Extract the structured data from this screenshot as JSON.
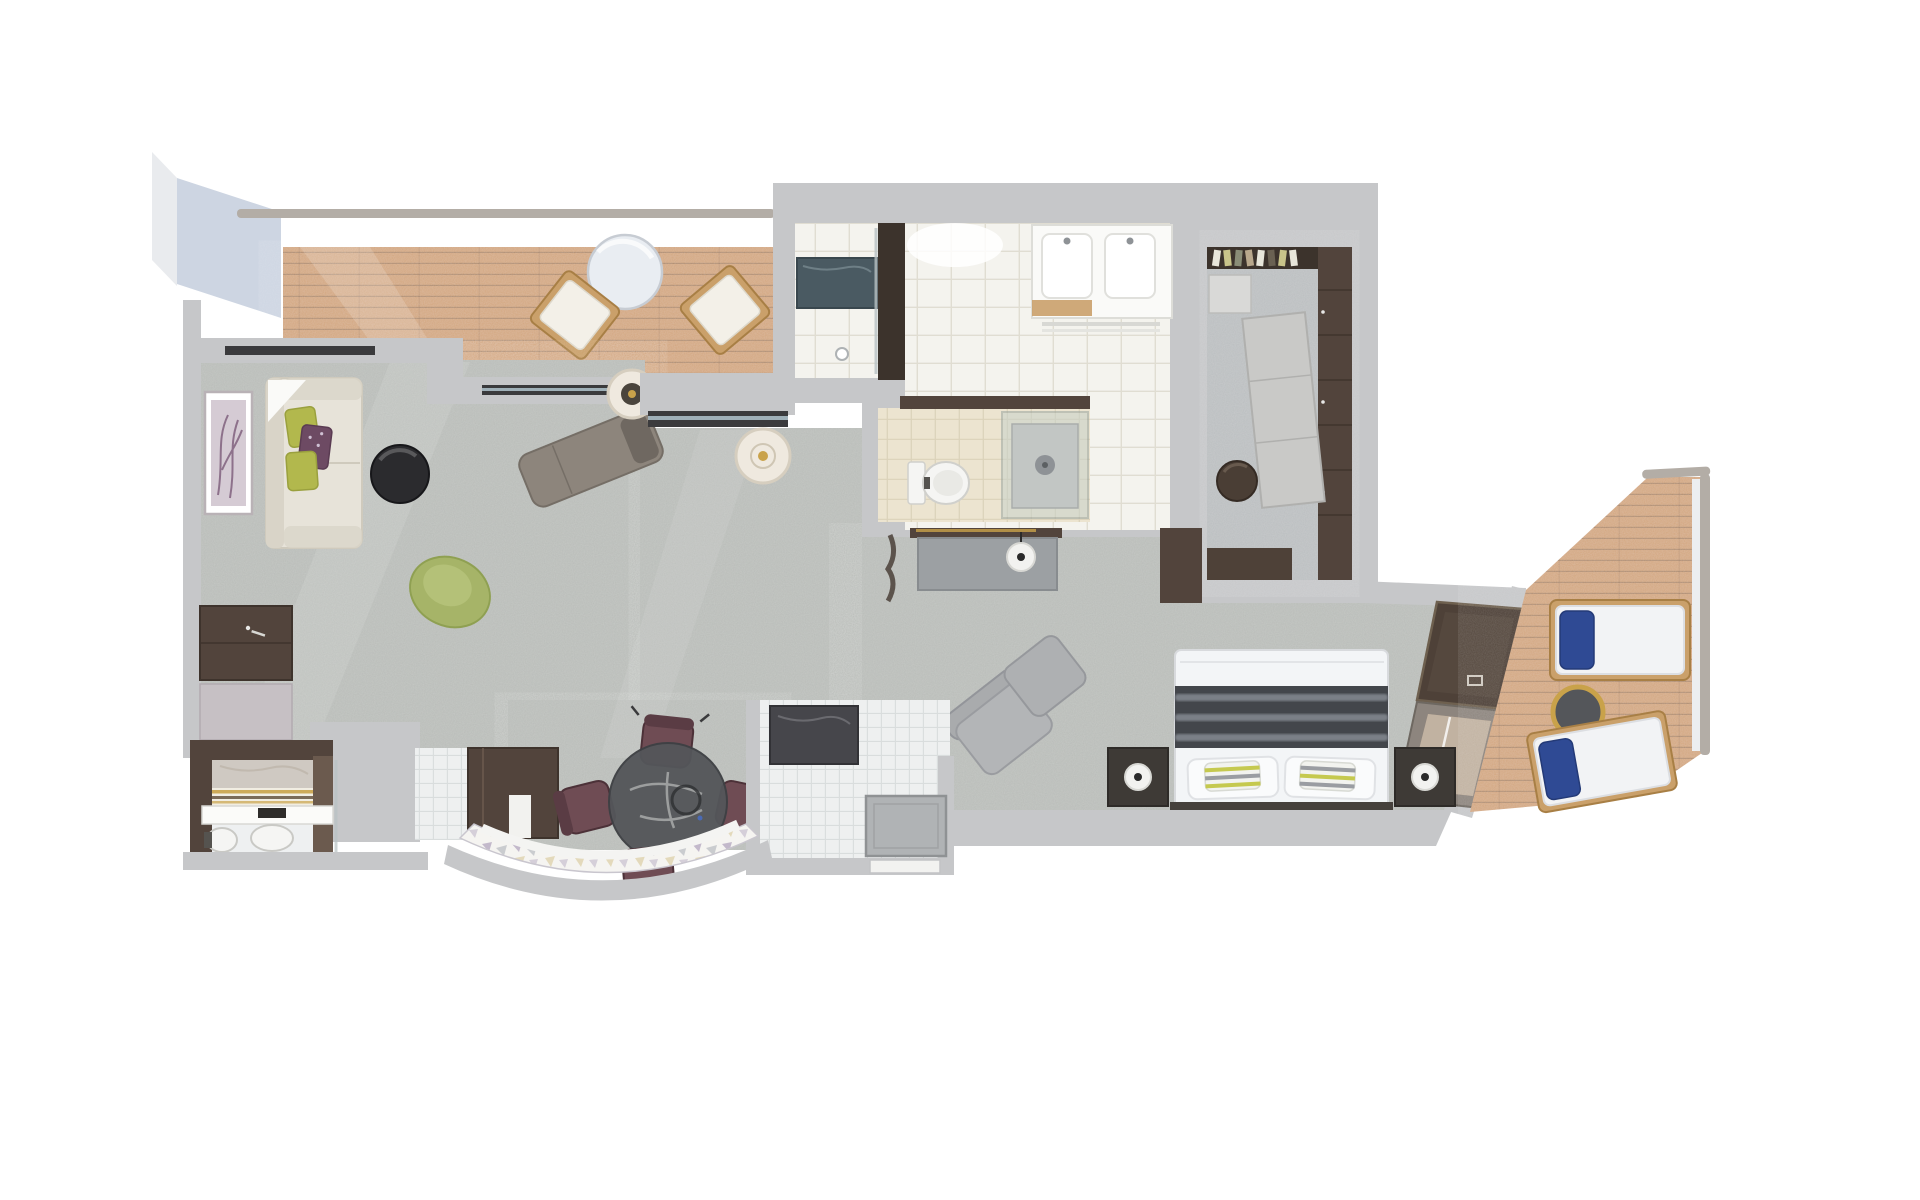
{
  "page": {
    "title": "Suite floor plan — 3D top-down rendering",
    "background": "#ffffff",
    "visible_text": "none"
  },
  "colors": {
    "wall": "#c6c7c9",
    "wallEdge": "#a9abad",
    "panelBlue": "#cdd5e2",
    "railing": "#b3ada6",
    "carpet": "#b8bbb7",
    "deck": "#d3a67e",
    "tileWhite": "#f4f3ee",
    "tileLineWhite": "#e0ddd2",
    "tileBeige": "#ece4d0",
    "tileLineBeige": "#dbd2ba",
    "tileSmall": "#eef0f0",
    "tileLineSmall": "#d9dddd",
    "walnut": "#52443c",
    "walnutDark": "#3c332c",
    "walnutLight": "#6b5a4e",
    "slate": "#4a5a62",
    "glassGreen": "#c8d2cc",
    "cream": "#e7e3d9",
    "creamDark": "#d9d4c8",
    "pillowGreen": "#b2b84d",
    "pillowPlum": "#6d4a63",
    "chairGreen": "#a6b468",
    "chaise": "#8d857c",
    "chaisePillow": "#6f6861",
    "coffeeTable": "#2b2b2e",
    "sideTableCream": "#efe9df",
    "gold": "#c9a24a",
    "desk": "#9ca0a3",
    "lampWhite": "#f2f2f0",
    "lampDot": "#2a2a2a",
    "bedWhite": "#f3f5f7",
    "runner": "#43464b",
    "runnerStripe": "#858a92",
    "accentGreen": "#c5c94f",
    "accentGray": "#9a9da2",
    "headboard": "#46413c",
    "nightstand": "#3e3a36",
    "armchair": "#b3b5b7",
    "ottoman": "#aeb0b2",
    "tvPanel": "#4e4138",
    "lounger": "#f2f3f5",
    "loungerFrame": "#caa06a",
    "navyPillow": "#2f4a94",
    "plumChair": "#6f4c54",
    "plumChairDark": "#5a3c44",
    "glassTableTop": "#54565a",
    "mauvePanel": "#c6c0c4",
    "counterDark": "#46464b",
    "trayGray": "#b0b3b5",
    "toiletWhite": "#f5f5f3",
    "fixtureGray": "#8e9296",
    "islandLight": "#c9c9c7",
    "poufBrown": "#4a3e35",
    "marblePanel": "#cfc9c2",
    "mosaicPurple": "#9b89ab",
    "mosaicGray": "#a7abb3",
    "mosaicGold": "#c9b26a"
  },
  "rooms": [
    {
      "id": "forward-balcony",
      "name": "Forward balcony",
      "floor": "teak deck",
      "furniture": [
        "round cafe table",
        "deck chair",
        "deck chair",
        "railing"
      ]
    },
    {
      "id": "living-room",
      "name": "Living room",
      "floor": "gray carpet",
      "furniture": [
        "sofa with green and plum pillows",
        "framed artwork",
        "round coffee table",
        "green swivel chair",
        "chaise lounge",
        "round side table with candle",
        "console cabinet"
      ]
    },
    {
      "id": "master-bathroom",
      "name": "Master bathroom",
      "floor": "white marble tile",
      "furniture": [
        "walk-in shower with slate bench",
        "double vanity",
        "twin sinks",
        "towel rail"
      ]
    },
    {
      "id": "water-closet",
      "name": "Toilet & shower room",
      "floor": "beige tile",
      "furniture": [
        "toilet",
        "glass shower enclosure"
      ]
    },
    {
      "id": "walk-in-closet",
      "name": "Walk-in closet",
      "floor": "stone",
      "furniture": [
        "hanging rail with clothes",
        "wardrobe column",
        "dresser island",
        "round pouf",
        "lower cabinets"
      ]
    },
    {
      "id": "desk-area",
      "name": "Desk nook",
      "floor": "gray carpet",
      "furniture": [
        "writing desk",
        "round desk lamp",
        "round side table with candle"
      ]
    },
    {
      "id": "bedroom",
      "name": "Bedroom",
      "floor": "gray carpet",
      "furniture": [
        "king bed with striped runner",
        "pillows",
        "nightstand with lamp",
        "nightstand with lamp",
        "armchair",
        "ottoman",
        "gold drum table",
        "TV wall panel",
        "glass balcony door"
      ]
    },
    {
      "id": "aft-balcony",
      "name": "Aft balcony",
      "floor": "teak deck",
      "furniture": [
        "sun lounger with navy pillow",
        "sun lounger with navy pillow",
        "gold drinks table",
        "railing"
      ]
    },
    {
      "id": "guest-bathroom",
      "name": "Guest bathroom",
      "floor": "white stone",
      "furniture": [
        "marble niche",
        "striped towel shelf",
        "vanity counter with black faucet",
        "basin",
        "toilet"
      ]
    },
    {
      "id": "dining-area",
      "name": "Dining area",
      "floor": "carpet + white mosaic tile",
      "furniture": [
        "round glass dining table",
        "dining chair",
        "dining chair",
        "dining chair",
        "dining chair",
        "wood partition wall"
      ]
    },
    {
      "id": "entry-foyer",
      "name": "Entry foyer",
      "floor": "white tile + petal mosaic",
      "furniture": [
        "dark console counter",
        "floor mat",
        "curved feature wall",
        "entry door"
      ]
    }
  ]
}
